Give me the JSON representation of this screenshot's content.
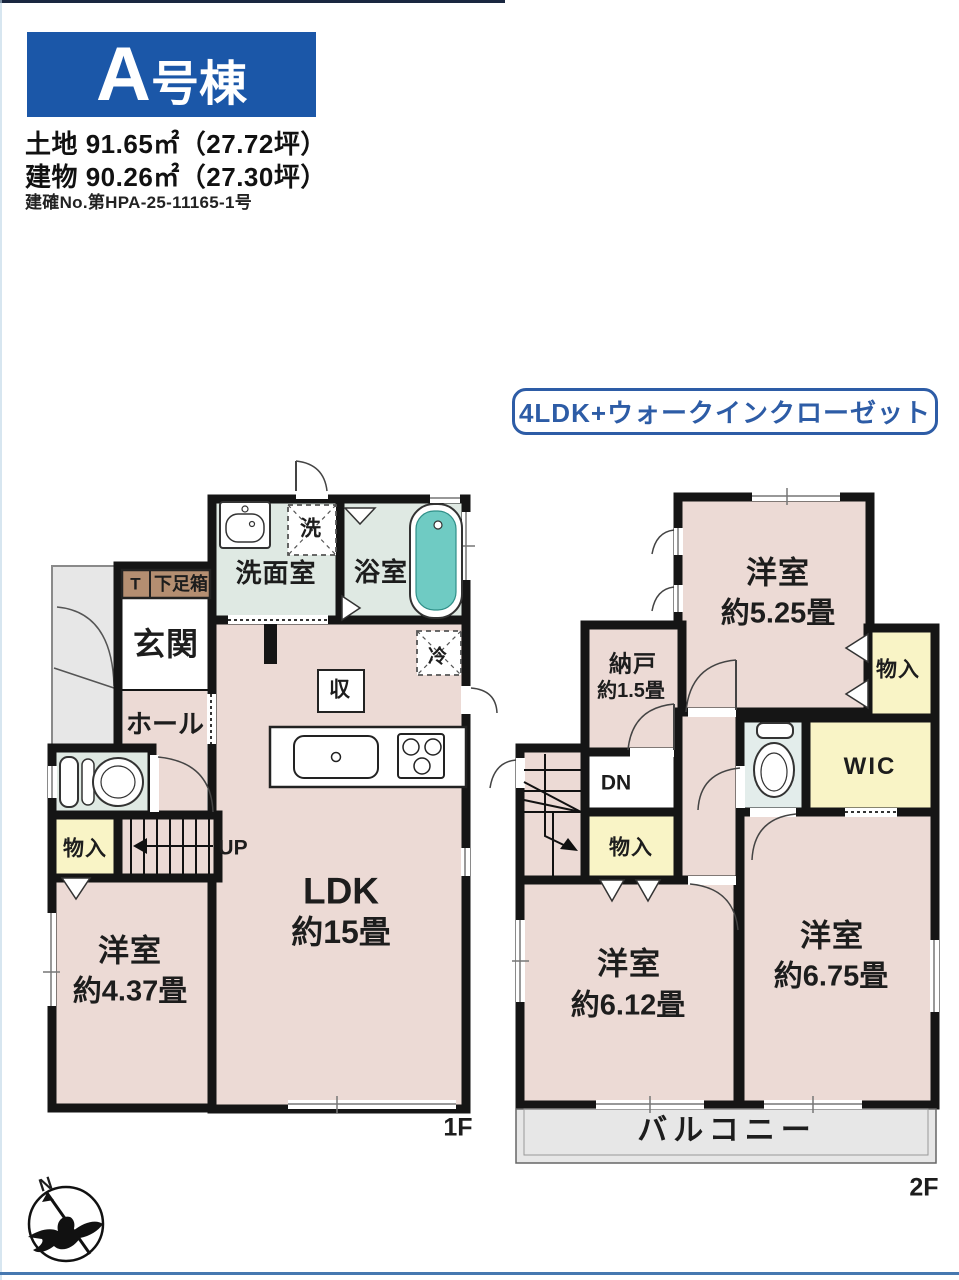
{
  "header": {
    "unit_letter": "A",
    "unit_suffix": "号棟",
    "land": "土地 91.65㎡（27.72坪）",
    "building": "建物 90.26㎡（27.30坪）",
    "permit": "建確No.第HPA-25-11165-1号"
  },
  "badge": {
    "label": "4LDK+ウォークインクローゼット"
  },
  "colors": {
    "accent_blue": "#1b57a8",
    "badge_blue": "#2d5ca6",
    "wall_black": "#151515",
    "floor_pink": "#ecdad5",
    "floor_green": "#dfe9e3",
    "floor_yellow": "#f9f4c6",
    "floor_gray": "#e7e7e7",
    "bathtub_teal": "#6fcbc3",
    "shoebox_brown": "#b48e71"
  },
  "f1": {
    "floor_label": "1F",
    "washroom": "洗面室",
    "bath": "浴室",
    "laundry": "洗",
    "shoe_t": "T",
    "shoe_box": "下足箱",
    "entrance": "玄関",
    "hall": "ホール",
    "storage": "収",
    "fridge": "冷",
    "up": "UP",
    "closet": "物入",
    "room437_name": "洋室",
    "room437_size": "約4.37畳",
    "ldk_name": "LDK",
    "ldk_size": "約15畳"
  },
  "f2": {
    "floor_label": "2F",
    "r525_name": "洋室",
    "r525_size": "約5.25畳",
    "closet_top": "物入",
    "nando_name": "納戸",
    "nando_size": "約1.5畳",
    "wic": "WIC",
    "dn": "DN",
    "closet_mid": "物入",
    "r612_name": "洋室",
    "r612_size": "約6.12畳",
    "r675_name": "洋室",
    "r675_size": "約6.75畳",
    "balcony": "バルコニー"
  },
  "compass": {
    "n": "N"
  }
}
